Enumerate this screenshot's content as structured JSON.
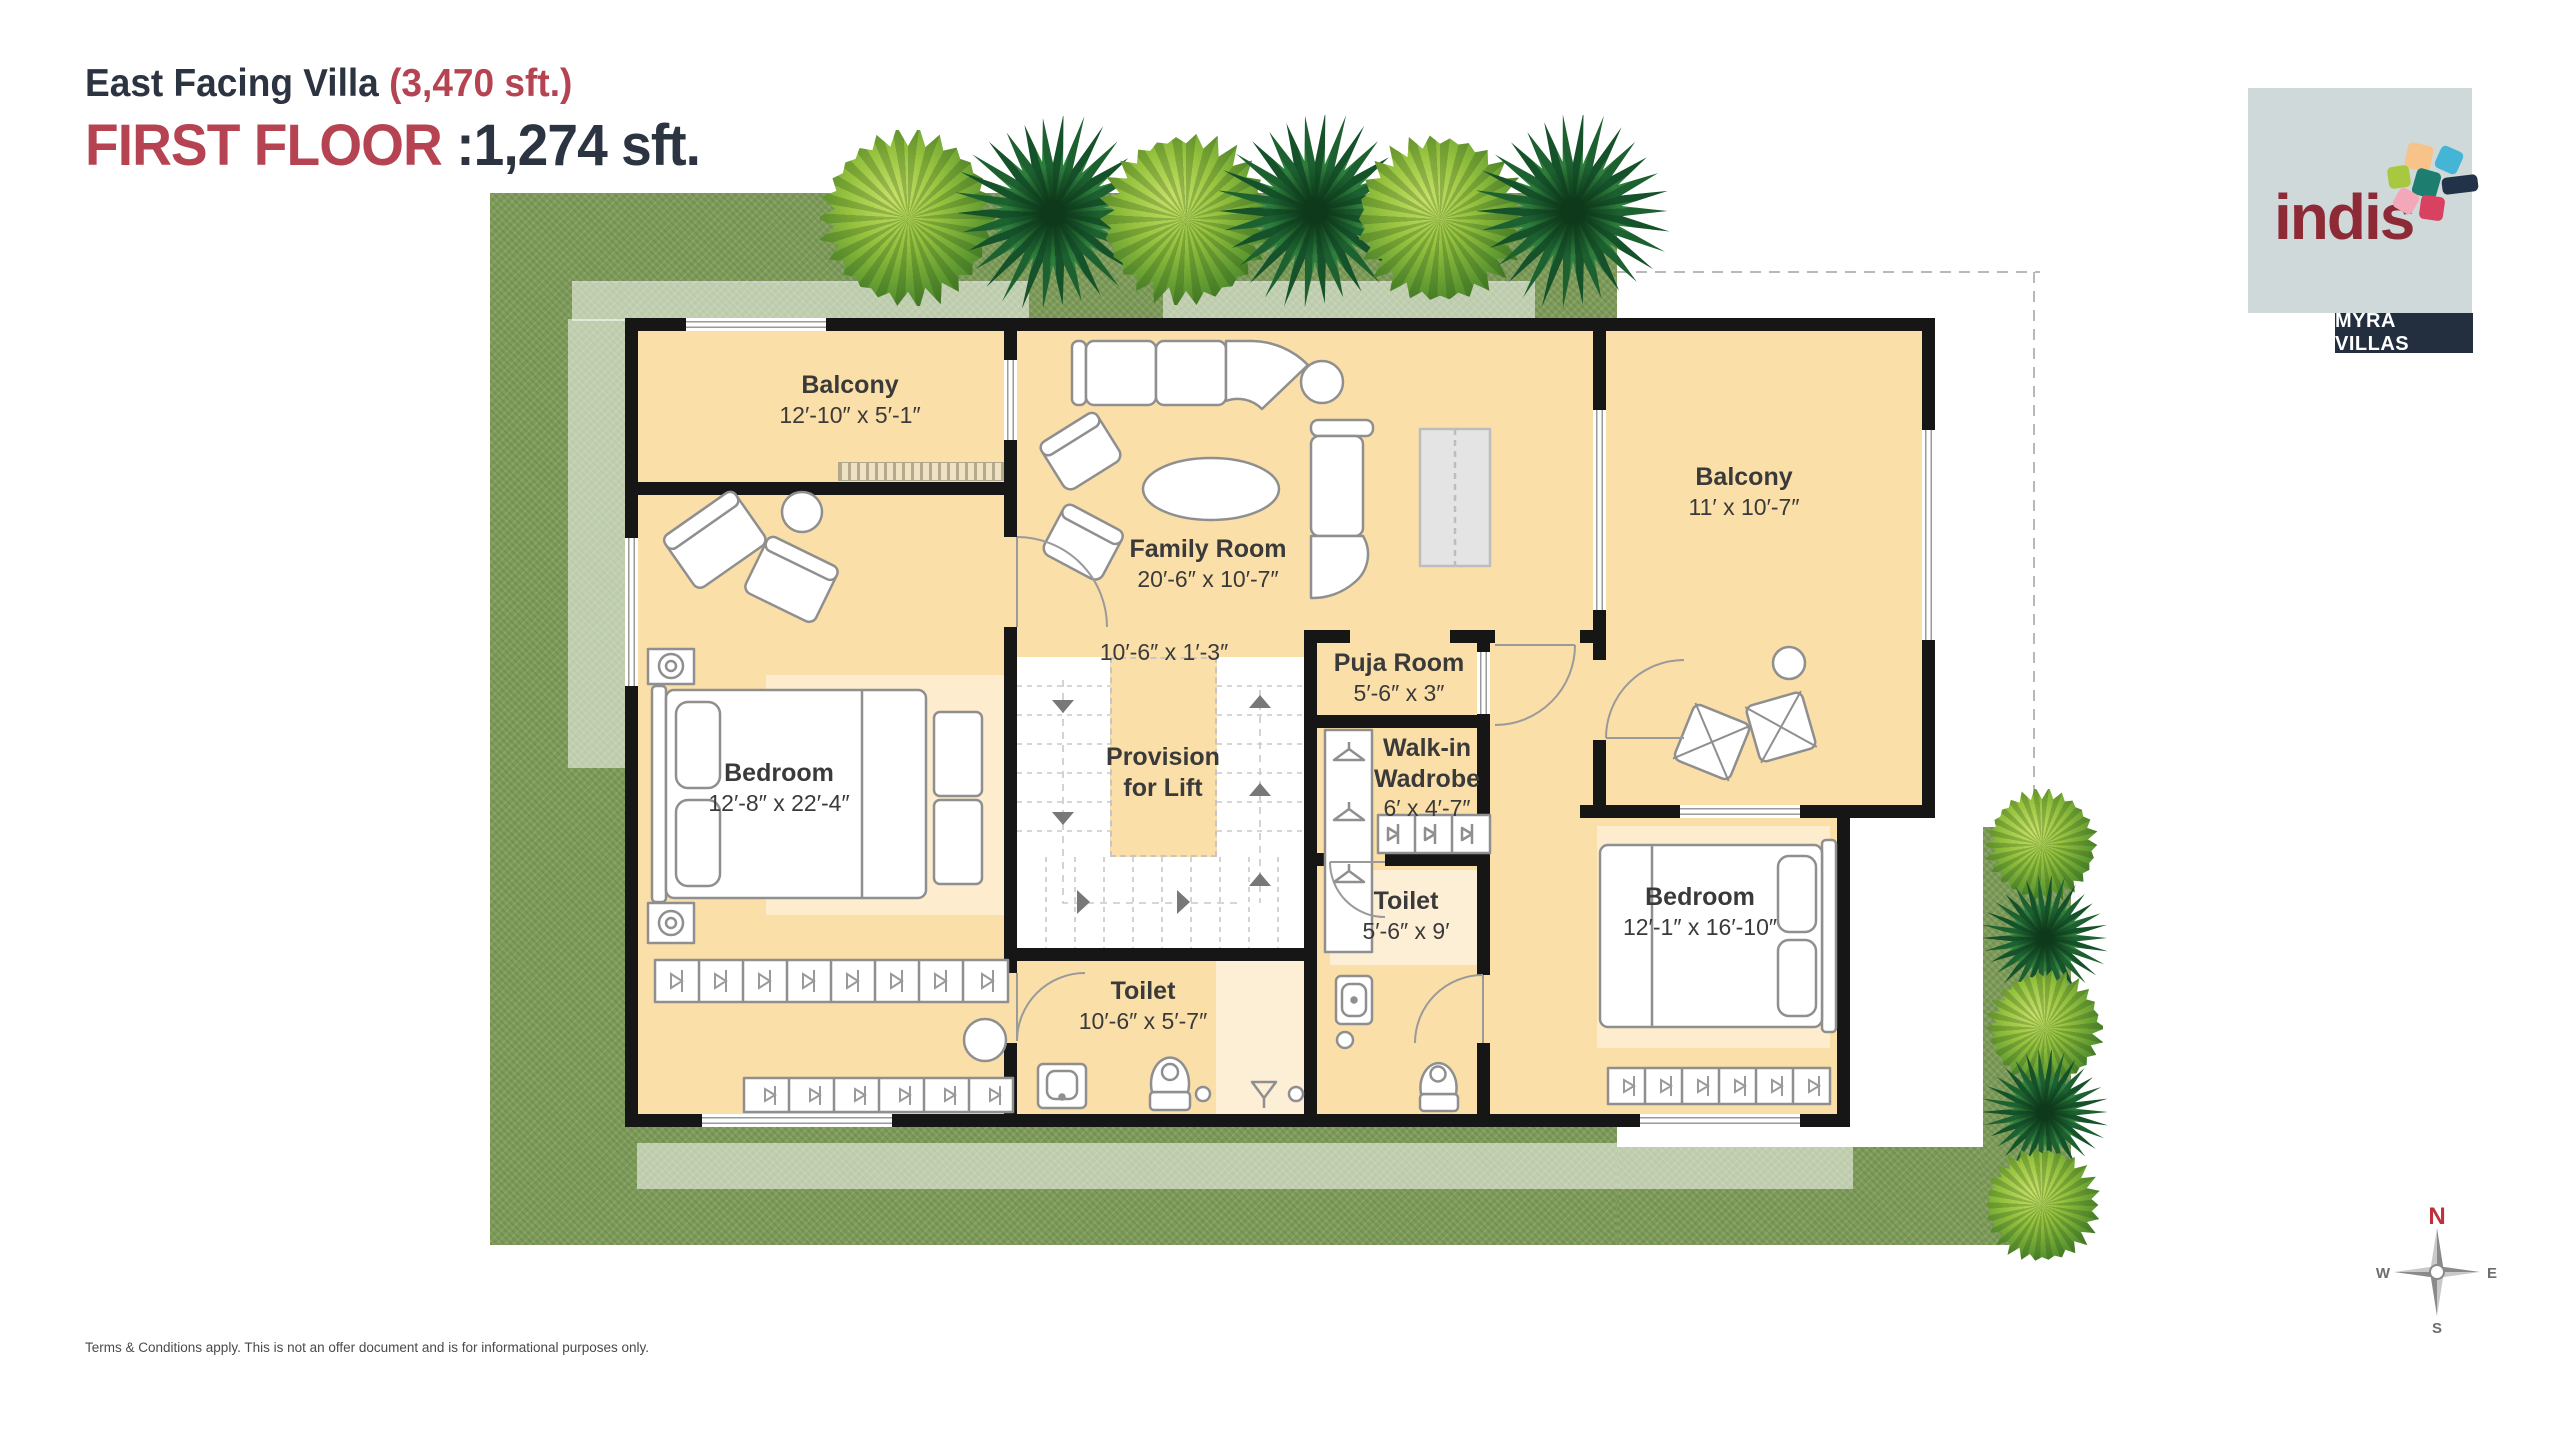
{
  "header": {
    "title": "East Facing Villa",
    "title_area": "(3,470 sft.)",
    "floor": "FIRST FLOOR",
    "floor_area": ":1,274 sft."
  },
  "logo": {
    "brand": "indis",
    "project": "MYRA VILLAS"
  },
  "rooms": {
    "balcony_left": {
      "name": "Balcony",
      "dims": "12′-10″ x 5′-1″"
    },
    "family": {
      "name": "Family Room",
      "dims": "20′-6″ x 10′-7″"
    },
    "corridor": {
      "dims": "10′-6″ x 1′-3″"
    },
    "puja": {
      "name": "Puja Room",
      "dims": "5′-6″ x 3″"
    },
    "lift": {
      "name": "Provision for Lift"
    },
    "wardrobe": {
      "name": "Walk-in Wadrobe",
      "dims": "6′ x 4′-7″"
    },
    "toilet_right": {
      "name": "Toilet",
      "dims": "5′-6″ x 9′"
    },
    "toilet_left": {
      "name": "Toilet",
      "dims": "10′-6″ x 5′-7″"
    },
    "bedroom_left": {
      "name": "Bedroom",
      "dims": "12′-8″ x 22′-4″"
    },
    "bedroom_right": {
      "name": "Bedroom",
      "dims": "12′-1″ x 16′-10″"
    },
    "balcony_right": {
      "name": "Balcony",
      "dims": "11′ x 10′-7″"
    }
  },
  "compass": {
    "n": "N",
    "e": "E",
    "s": "S",
    "w": "W"
  },
  "footer": {
    "disclaimer": "Terms & Conditions apply. This is not an offer document and is for informational purposes only."
  },
  "colors": {
    "accent_red": "#B54352",
    "navy": "#2B3440",
    "floor": "#FBDFA9",
    "floor_light": "#FDEED6",
    "wall": "#161616",
    "grass": "#7E9B5B",
    "logo_maroon": "#8E2A35",
    "logo_bg": "#CFD9DA",
    "badge_bg": "#232F3F"
  }
}
